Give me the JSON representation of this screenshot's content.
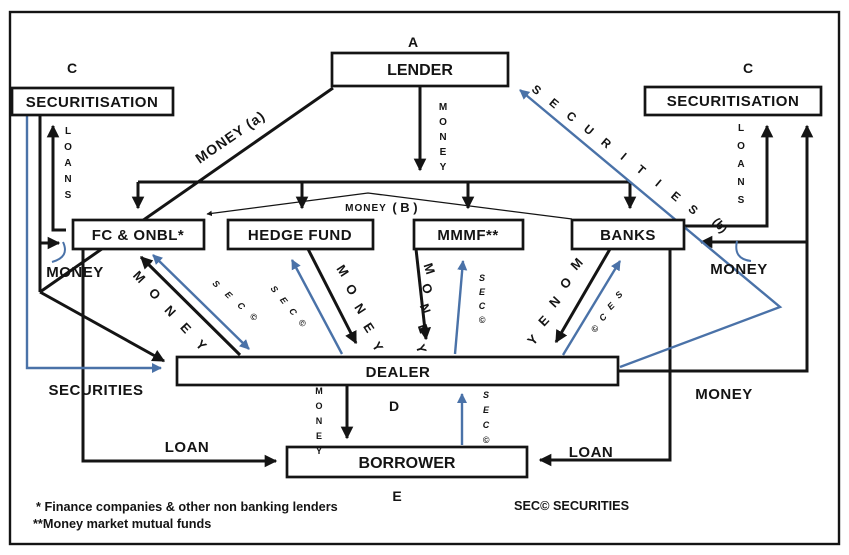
{
  "diagram_title": "Shadow banking money and securities flow diagram",
  "colors": {
    "line_black": "#141414",
    "accent_blue": "#4a72a8",
    "box_fill": "#ffffff"
  },
  "boxes": {
    "lender": "LENDER",
    "securitisation_left": "SECURITISATION",
    "securitisation_right": "SECURITISATION",
    "fc_onbl": "FC & ONBL*",
    "hedge_fund": "HEDGE FUND",
    "mmmf": "MMMF**",
    "banks": "BANKS",
    "dealer": "DEALER",
    "borrower": "BORROWER"
  },
  "markers": {
    "a": "A",
    "b_money": "MONEY",
    "b": "( B )",
    "c_left": "C",
    "c_right": "C",
    "d": "D",
    "e": "E"
  },
  "labels": {
    "money_a": "MONEY (a)",
    "securities_b": "SECURITIES",
    "securities_b_suffix": "(b)",
    "loans_left": "LOANS",
    "loans_right": "LOANS",
    "money_lender_down": "MONEY",
    "money_left": "MONEY",
    "money_right": "MONEY",
    "money_bottom_right": "MONEY",
    "securities_left": "SECURITIES",
    "loan_left": "LOAN",
    "loan_right": "LOAN",
    "money_dealer_borrower": "MONEY",
    "sec_borrower": "SEC©",
    "money_fc": "MONEY",
    "sec_fc": "SEC©",
    "sec_hedge": "SEC©",
    "money_hedge": "MONEY",
    "money_mmmf": "MONEY",
    "sec_mmmf": "SEC©",
    "money_banks": "MONEY",
    "sec_banks": "SEC©"
  },
  "footnotes": {
    "fn1": "*   Finance companies & other non banking lenders",
    "fn2": "**Money market mutual funds",
    "legend": "SEC©  SECURITIES"
  }
}
